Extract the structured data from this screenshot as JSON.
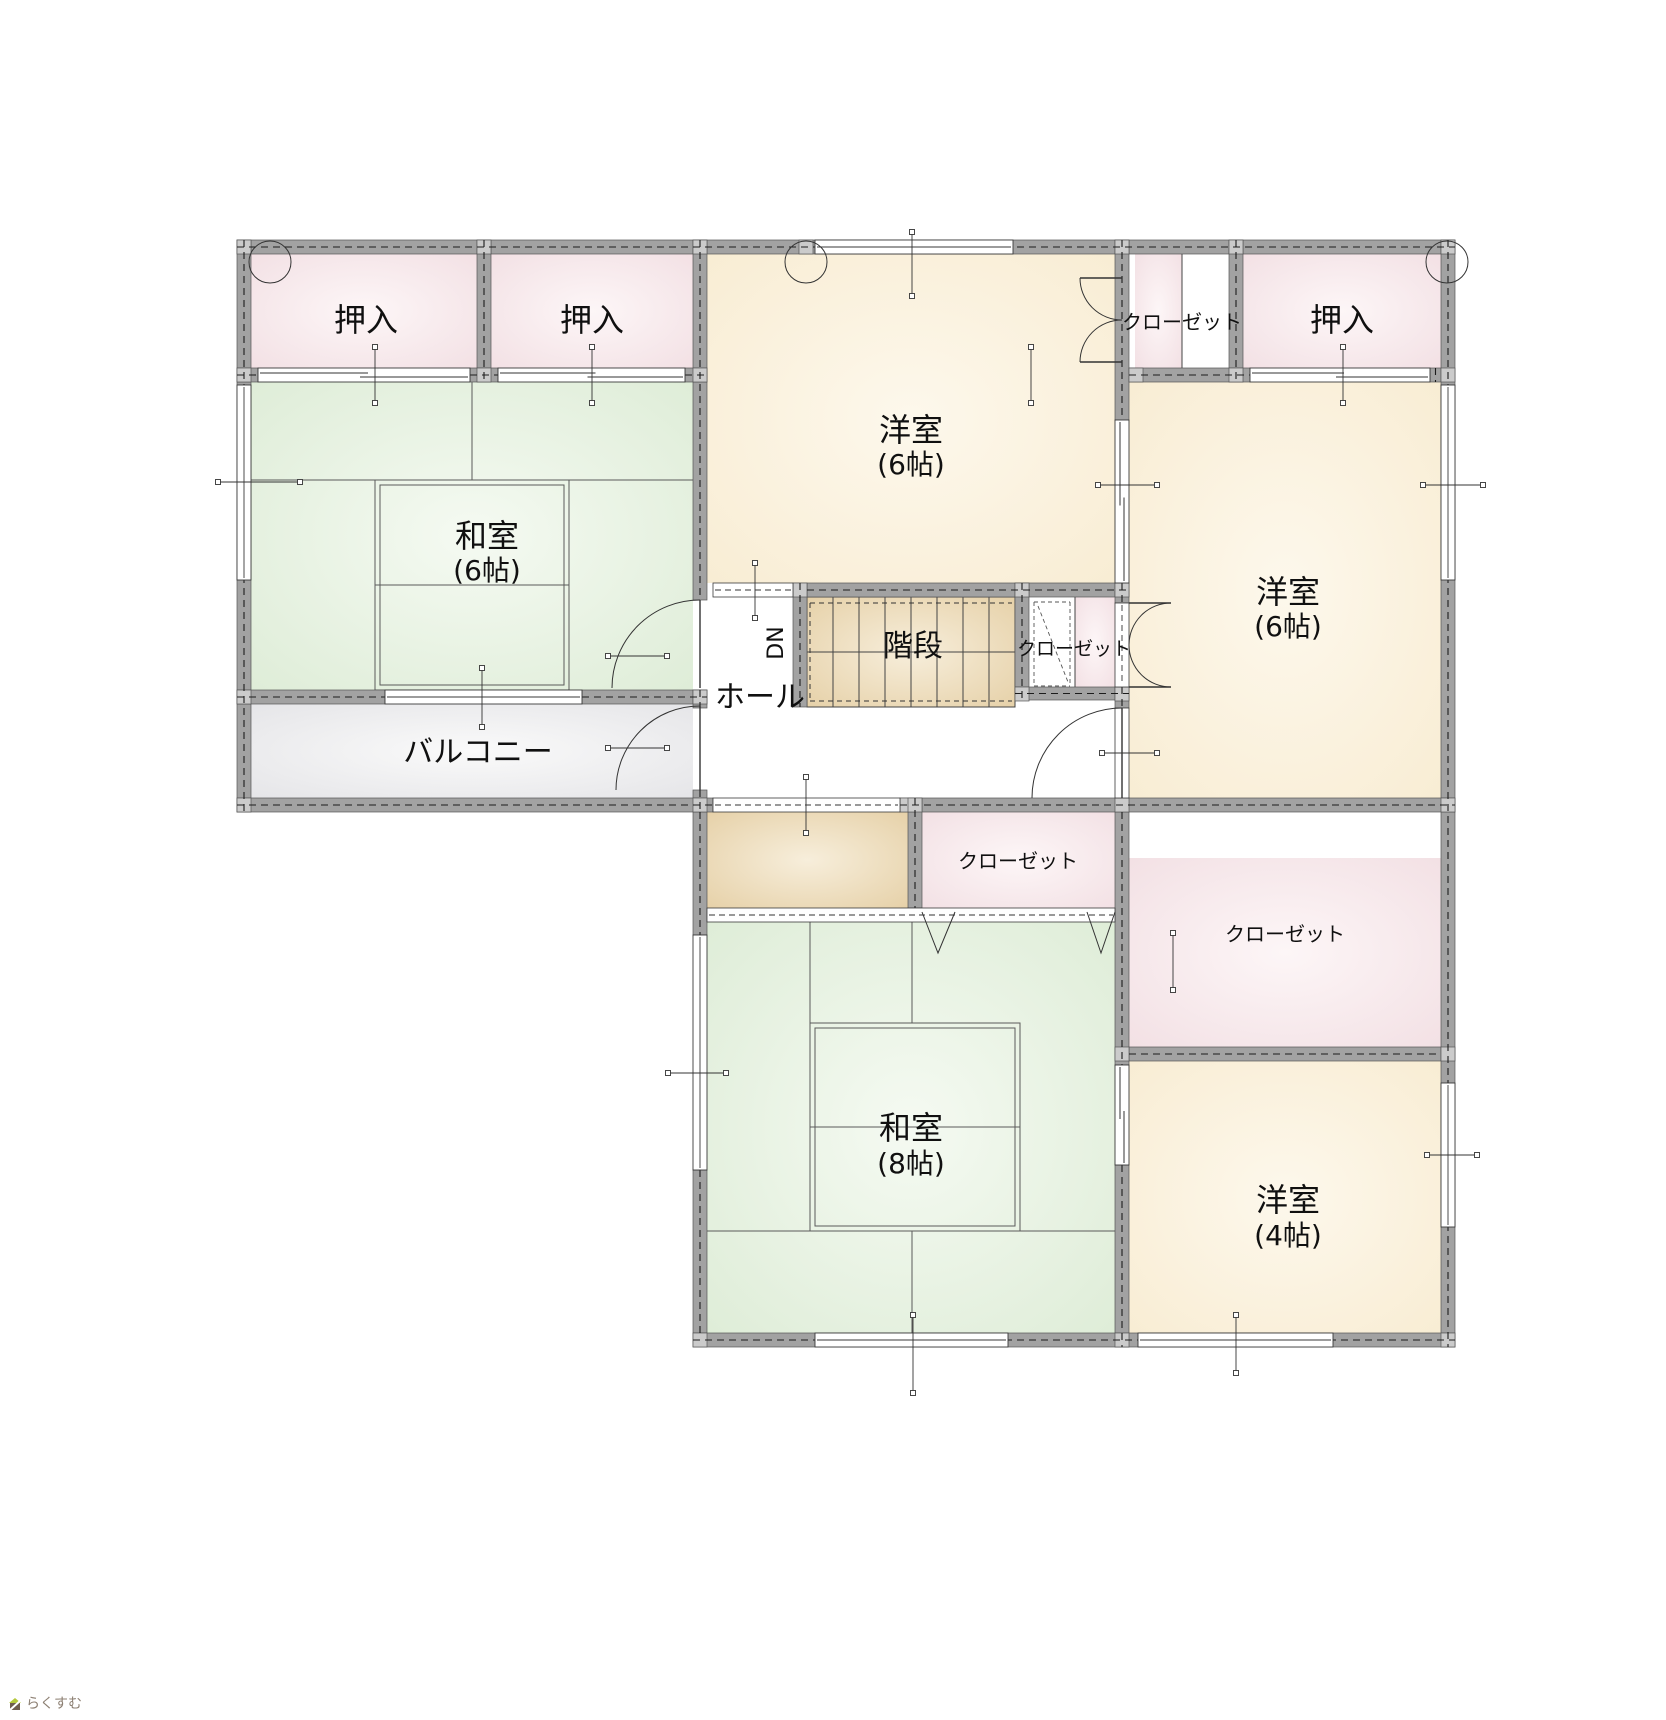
{
  "watermark": {
    "text": "らくすむ"
  },
  "plan": {
    "colors": {
      "wall": "#a2a2a2",
      "wall_edge": "#565656",
      "joint": "#cbcbcb",
      "line": "#1c1c1c",
      "tatami_line": "#5a5a5a",
      "text": "#101010",
      "pink_edge": "#f2dfe3",
      "pink_center": "#fdf6f7",
      "tatami_edge": "#ddecd6",
      "tatami_center": "#f5faf2",
      "cream_edge": "#f8ecd2",
      "cream_center": "#fdf8ec",
      "tan_edge": "#e5cfa5",
      "tan_center": "#f7eedb",
      "gray_edge": "#e4e4e7",
      "gray_center": "#fafafa"
    },
    "fills": [
      {
        "x": 251,
        "y": 254,
        "w": 226,
        "h": 114,
        "f": "pink",
        "n": "oshiire-left-1"
      },
      {
        "x": 491,
        "y": 254,
        "w": 202,
        "h": 114,
        "f": "pink",
        "n": "oshiire-left-2"
      },
      {
        "x": 1243,
        "y": 254,
        "w": 198,
        "h": 114,
        "f": "pink",
        "n": "oshiire-right"
      },
      {
        "x": 1135,
        "y": 254,
        "w": 47,
        "h": 114,
        "f": "pink",
        "n": "closet-top-right"
      },
      {
        "x": 1182,
        "y": 254,
        "w": 47,
        "h": 114,
        "f": "white",
        "n": "closet-top-right-open"
      },
      {
        "x": 251,
        "y": 382,
        "w": 442,
        "h": 308,
        "f": "tatami",
        "n": "washitsu-6"
      },
      {
        "x": 707,
        "y": 254,
        "w": 408,
        "h": 329,
        "f": "cream",
        "n": "yoshitsu-6-middle"
      },
      {
        "x": 1129,
        "y": 382,
        "w": 312,
        "h": 416,
        "f": "cream",
        "n": "yoshitsu-6-right"
      },
      {
        "x": 251,
        "y": 704,
        "w": 442,
        "h": 94,
        "f": "gray",
        "n": "balcony"
      },
      {
        "x": 807,
        "y": 597,
        "w": 208,
        "h": 110,
        "f": "tan",
        "n": "stairs"
      },
      {
        "x": 1029,
        "y": 597,
        "w": 46,
        "h": 90,
        "f": "white",
        "n": "stair-closet"
      },
      {
        "x": 1075,
        "y": 597,
        "w": 40,
        "h": 90,
        "f": "pink",
        "n": "stair-closet-side"
      },
      {
        "x": 707,
        "y": 812,
        "w": 201,
        "h": 96,
        "f": "tan",
        "n": "landing"
      },
      {
        "x": 922,
        "y": 812,
        "w": 193,
        "h": 96,
        "f": "pink",
        "n": "closet-middle"
      },
      {
        "x": 1129,
        "y": 858,
        "w": 312,
        "h": 189,
        "f": "pink",
        "n": "closet-right"
      },
      {
        "x": 707,
        "y": 922,
        "w": 408,
        "h": 411,
        "f": "tatami",
        "n": "washitsu-8"
      },
      {
        "x": 1129,
        "y": 1061,
        "w": 312,
        "h": 272,
        "f": "cream",
        "n": "yoshitsu-4"
      }
    ],
    "walls": [
      [
        237,
        240,
        1218,
        14
      ],
      [
        237,
        240,
        14,
        572
      ],
      [
        477,
        240,
        14,
        142
      ],
      [
        693,
        240,
        14,
        360
      ],
      [
        1115,
        240,
        14,
        180
      ],
      [
        1229,
        240,
        14,
        142
      ],
      [
        1441,
        240,
        14,
        1107
      ],
      [
        237,
        368,
        21,
        14
      ],
      [
        470,
        368,
        28,
        14
      ],
      [
        685,
        368,
        22,
        14
      ],
      [
        1129,
        368,
        121,
        14
      ],
      [
        1430,
        368,
        11,
        14
      ],
      [
        807,
        583,
        322,
        14
      ],
      [
        793,
        583,
        14,
        124
      ],
      [
        1015,
        583,
        14,
        117
      ],
      [
        1015,
        687,
        114,
        13
      ],
      [
        1115,
        583,
        14,
        20
      ],
      [
        1115,
        687,
        14,
        21
      ],
      [
        237,
        690,
        148,
        14
      ],
      [
        582,
        690,
        125,
        14
      ],
      [
        693,
        690,
        14,
        18
      ],
      [
        693,
        790,
        14,
        22
      ],
      [
        237,
        798,
        476,
        14
      ],
      [
        900,
        798,
        555,
        14
      ],
      [
        908,
        798,
        14,
        110
      ],
      [
        693,
        812,
        14,
        123
      ],
      [
        693,
        1170,
        14,
        163
      ],
      [
        1115,
        812,
        14,
        253
      ],
      [
        1115,
        1165,
        14,
        182
      ],
      [
        1129,
        1047,
        312,
        14
      ],
      [
        693,
        1333,
        762,
        14
      ]
    ],
    "joints": [
      [
        237,
        240
      ],
      [
        477,
        240
      ],
      [
        693,
        240
      ],
      [
        799,
        240
      ],
      [
        1115,
        240
      ],
      [
        1229,
        240
      ],
      [
        1441,
        240
      ],
      [
        237,
        368
      ],
      [
        477,
        368
      ],
      [
        693,
        368
      ],
      [
        1129,
        368
      ],
      [
        1229,
        368
      ],
      [
        1441,
        368
      ],
      [
        793,
        583
      ],
      [
        1015,
        583
      ],
      [
        1115,
        583
      ],
      [
        237,
        690
      ],
      [
        693,
        690
      ],
      [
        1015,
        687
      ],
      [
        1115,
        687
      ],
      [
        237,
        798
      ],
      [
        693,
        798
      ],
      [
        900,
        798
      ],
      [
        908,
        798
      ],
      [
        1115,
        798
      ],
      [
        1441,
        798
      ],
      [
        1115,
        1047
      ],
      [
        1441,
        1047
      ],
      [
        693,
        1333
      ],
      [
        1115,
        1333
      ],
      [
        1441,
        1333
      ]
    ],
    "windows": [
      [
        237,
        385,
        14,
        195
      ],
      [
        1441,
        385,
        14,
        195
      ],
      [
        1441,
        1083,
        14,
        144
      ],
      [
        385,
        690,
        197,
        14
      ],
      [
        815,
        240,
        198,
        14
      ],
      [
        815,
        1333,
        193,
        14
      ],
      [
        1138,
        1333,
        195,
        14
      ],
      [
        693,
        935,
        14,
        235
      ]
    ],
    "sliders": [
      [
        258,
        368,
        212,
        14
      ],
      [
        498,
        368,
        187,
        14
      ],
      [
        1250,
        368,
        180,
        14
      ],
      [
        1115,
        420,
        14,
        163
      ],
      [
        1115,
        1065,
        14,
        100
      ]
    ],
    "openings": [
      [
        713,
        583,
        80,
        14
      ],
      [
        713,
        798,
        187,
        14
      ],
      [
        707,
        908,
        408,
        14
      ],
      [
        1115,
        603,
        14,
        84
      ],
      [
        1115,
        708,
        14,
        90
      ]
    ],
    "stairs": {
      "x": 807,
      "y": 597,
      "w": 208,
      "h": 110,
      "steps": 8
    },
    "stairs_dashed": [
      [
        810,
        603,
        1012,
        603
      ],
      [
        810,
        701,
        1012,
        701
      ],
      [
        810,
        603,
        810,
        701
      ]
    ],
    "tatami": [
      [
        251,
        480,
        693,
        480
      ],
      [
        472,
        382,
        472,
        480
      ],
      [
        375,
        480,
        375,
        690
      ],
      [
        569,
        480,
        569,
        690
      ],
      [
        375,
        585,
        569,
        585
      ],
      [
        810,
        1023,
        1020,
        1023
      ],
      [
        707,
        1231,
        1115,
        1231
      ],
      [
        810,
        922,
        810,
        1231
      ],
      [
        1020,
        1023,
        1020,
        1231
      ],
      [
        912,
        922,
        912,
        1023
      ],
      [
        912,
        1231,
        912,
        1333
      ],
      [
        810,
        1127,
        1020,
        1127
      ]
    ],
    "tatami_boxes": [
      [
        375,
        480,
        194,
        210
      ],
      [
        380,
        485,
        184,
        200
      ],
      [
        810,
        1023,
        210,
        208
      ],
      [
        815,
        1028,
        200,
        198
      ]
    ],
    "detail_lines": [
      [
        1182,
        254,
        1182,
        368
      ],
      [
        1075,
        597,
        1075,
        687
      ]
    ],
    "detail_dashed": [
      [
        1034,
        602,
        1070,
        602
      ],
      [
        1034,
        686,
        1070,
        686
      ],
      [
        1034,
        602,
        1034,
        686
      ],
      [
        1070,
        602,
        1070,
        686
      ],
      [
        1038,
        606,
        1068,
        682
      ]
    ],
    "vmarks": [
      [
        922,
        912,
        938,
        953,
        955,
        912
      ],
      [
        1087,
        912,
        1101,
        953,
        1115,
        912
      ]
    ],
    "doors": [
      {
        "path": "M 700 600 A 88 88 0 0 0 612 688",
        "leaf": [
          700,
          688,
          700,
          600
        ],
        "n": "door-washitsu6"
      },
      {
        "path": "M 700 706 A 84 84 0 0 0 616 790",
        "leaf": [
          700,
          790,
          700,
          706
        ],
        "n": "door-balcony"
      },
      {
        "path": "M 1122 708 A 90 90 0 0 0 1032 798",
        "leaf": [
          1122,
          798,
          1122,
          708
        ],
        "n": "door-yoshitsu6-right"
      },
      {
        "path": "M 1080 278 A 42 42 0 0 0 1122 320",
        "leaf": [
          1122,
          278,
          1080,
          278
        ],
        "n": "door-closet-top-a"
      },
      {
        "path": "M 1080 362 A 42 42 0 0 1 1122 320",
        "leaf": [
          1122,
          362,
          1080,
          362
        ],
        "n": "door-closet-top-b"
      },
      {
        "path": "M 1171 603 A 42 42 0 0 0 1129 645",
        "leaf": [
          1129,
          603,
          1171,
          603
        ],
        "n": "door-stair-closet-a"
      },
      {
        "path": "M 1171 687 A 42 42 0 0 1 1129 645",
        "leaf": [
          1129,
          687,
          1171,
          687
        ],
        "n": "door-stair-closet-b"
      }
    ],
    "circles": [
      [
        270,
        262,
        21
      ],
      [
        806,
        262,
        21
      ],
      [
        1447,
        262,
        21
      ]
    ],
    "markers": [
      [
        375,
        347,
        375,
        403
      ],
      [
        592,
        347,
        592,
        403
      ],
      [
        1343,
        347,
        1343,
        403
      ],
      [
        1031,
        347,
        1031,
        403
      ],
      [
        218,
        482,
        300,
        482
      ],
      [
        912,
        232,
        912,
        296
      ],
      [
        482,
        668,
        482,
        727
      ],
      [
        1098,
        485,
        1157,
        485
      ],
      [
        1423,
        485,
        1483,
        485
      ],
      [
        608,
        656,
        667,
        656
      ],
      [
        608,
        748,
        667,
        748
      ],
      [
        755,
        563,
        755,
        618
      ],
      [
        806,
        777,
        806,
        833
      ],
      [
        1102,
        753,
        1157,
        753
      ],
      [
        1173,
        933,
        1173,
        990
      ],
      [
        668,
        1073,
        726,
        1073
      ],
      [
        913,
        1315,
        913,
        1393
      ],
      [
        1236,
        1315,
        1236,
        1373
      ],
      [
        1427,
        1155,
        1477,
        1155
      ]
    ],
    "labels": [
      {
        "n": "label-oshiire-left-1",
        "t": "押入",
        "x": 366,
        "y": 331,
        "fs": 32
      },
      {
        "n": "label-oshiire-left-2",
        "t": "押入",
        "x": 592,
        "y": 331,
        "fs": 32
      },
      {
        "n": "label-oshiire-right",
        "t": "押入",
        "x": 1342,
        "y": 331,
        "fs": 32
      },
      {
        "n": "label-closet-top-right",
        "t": "クローゼット",
        "x": 1182,
        "y": 329,
        "fs": 20
      },
      {
        "n": "label-washitsu-6",
        "t": "和室",
        "x": 487,
        "y": 547,
        "fs": 32
      },
      {
        "n": "label-washitsu-6-size",
        "t": "(6帖)",
        "x": 487,
        "y": 580,
        "fs": 28
      },
      {
        "n": "label-yoshitsu-6-middle",
        "t": "洋室",
        "x": 911,
        "y": 441,
        "fs": 32
      },
      {
        "n": "label-yoshitsu-6-middle-size",
        "t": "(6帖)",
        "x": 911,
        "y": 474,
        "fs": 28
      },
      {
        "n": "label-yoshitsu-6-right",
        "t": "洋室",
        "x": 1288,
        "y": 603,
        "fs": 32
      },
      {
        "n": "label-yoshitsu-6-right-size",
        "t": "(6帖)",
        "x": 1288,
        "y": 636,
        "fs": 28
      },
      {
        "n": "label-balcony",
        "t": "バルコニー",
        "x": 478,
        "y": 762,
        "fs": 30
      },
      {
        "n": "label-hall",
        "t": "ホール",
        "x": 760,
        "y": 707,
        "fs": 30
      },
      {
        "n": "label-stairs",
        "t": "階段",
        "x": 913,
        "y": 656,
        "fs": 30
      },
      {
        "n": "label-dn",
        "t": "DN",
        "x": 783,
        "y": 643,
        "fs": 22,
        "rot": -90
      },
      {
        "n": "label-stair-closet",
        "t": "クローゼット",
        "x": 1074,
        "y": 655,
        "fs": 19
      },
      {
        "n": "label-closet-middle",
        "t": "クローゼット",
        "x": 1018,
        "y": 868,
        "fs": 20
      },
      {
        "n": "label-closet-right",
        "t": "クローゼット",
        "x": 1285,
        "y": 941,
        "fs": 20
      },
      {
        "n": "label-washitsu-8",
        "t": "和室",
        "x": 911,
        "y": 1139,
        "fs": 32
      },
      {
        "n": "label-washitsu-8-size",
        "t": "(8帖)",
        "x": 911,
        "y": 1173,
        "fs": 28
      },
      {
        "n": "label-yoshitsu-4",
        "t": "洋室",
        "x": 1288,
        "y": 1211,
        "fs": 32
      },
      {
        "n": "label-yoshitsu-4-size",
        "t": "(4帖)",
        "x": 1288,
        "y": 1245,
        "fs": 28
      }
    ]
  }
}
